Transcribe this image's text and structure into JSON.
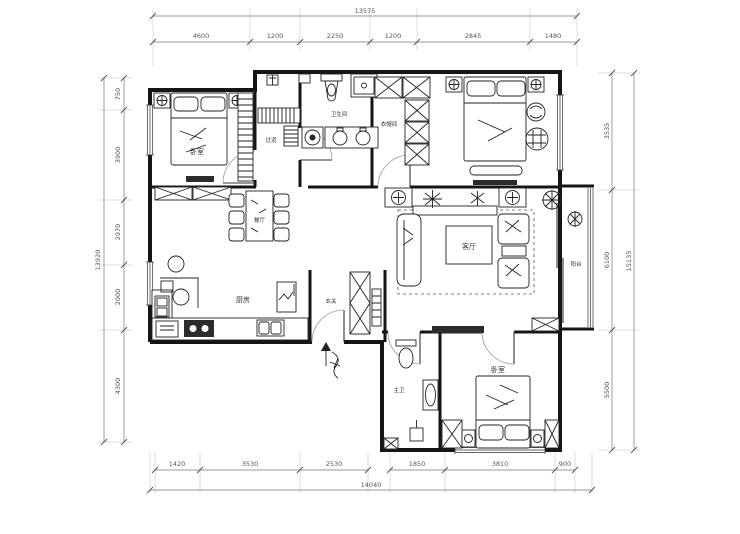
{
  "rooms": {
    "bedroom1": "卧室",
    "hallway": "过道",
    "bathroom_main": "卫生间",
    "cloakroom": "衣帽间",
    "dining": "餐厅",
    "living": "客厅",
    "balcony": "阳台",
    "kitchen": "厨房",
    "entry": "玄关",
    "bathroom_ensuite": "主卫",
    "bedroom2": "卧室",
    "entry_arrow": "入户"
  },
  "dimensions": {
    "top": {
      "total": "13575",
      "segments": [
        "4600",
        "1200",
        "2250",
        "1200",
        "2845",
        "1480"
      ]
    },
    "bottom": {
      "total": "14040",
      "segments": [
        "1420",
        "3530",
        "2530",
        "1850",
        "3810",
        "900"
      ]
    },
    "left": {
      "total": "13920",
      "segments": [
        "750",
        "3900",
        "2970",
        "2000",
        "4300"
      ]
    },
    "right": {
      "total": "15135",
      "segments": [
        "3535",
        "6100",
        "5500"
      ]
    }
  },
  "colors": {
    "background": "#ffffff",
    "wall": "#151515",
    "dimension_line": "#777777",
    "furniture_line": "#222222",
    "dark_fill": "#2b2b2b"
  }
}
